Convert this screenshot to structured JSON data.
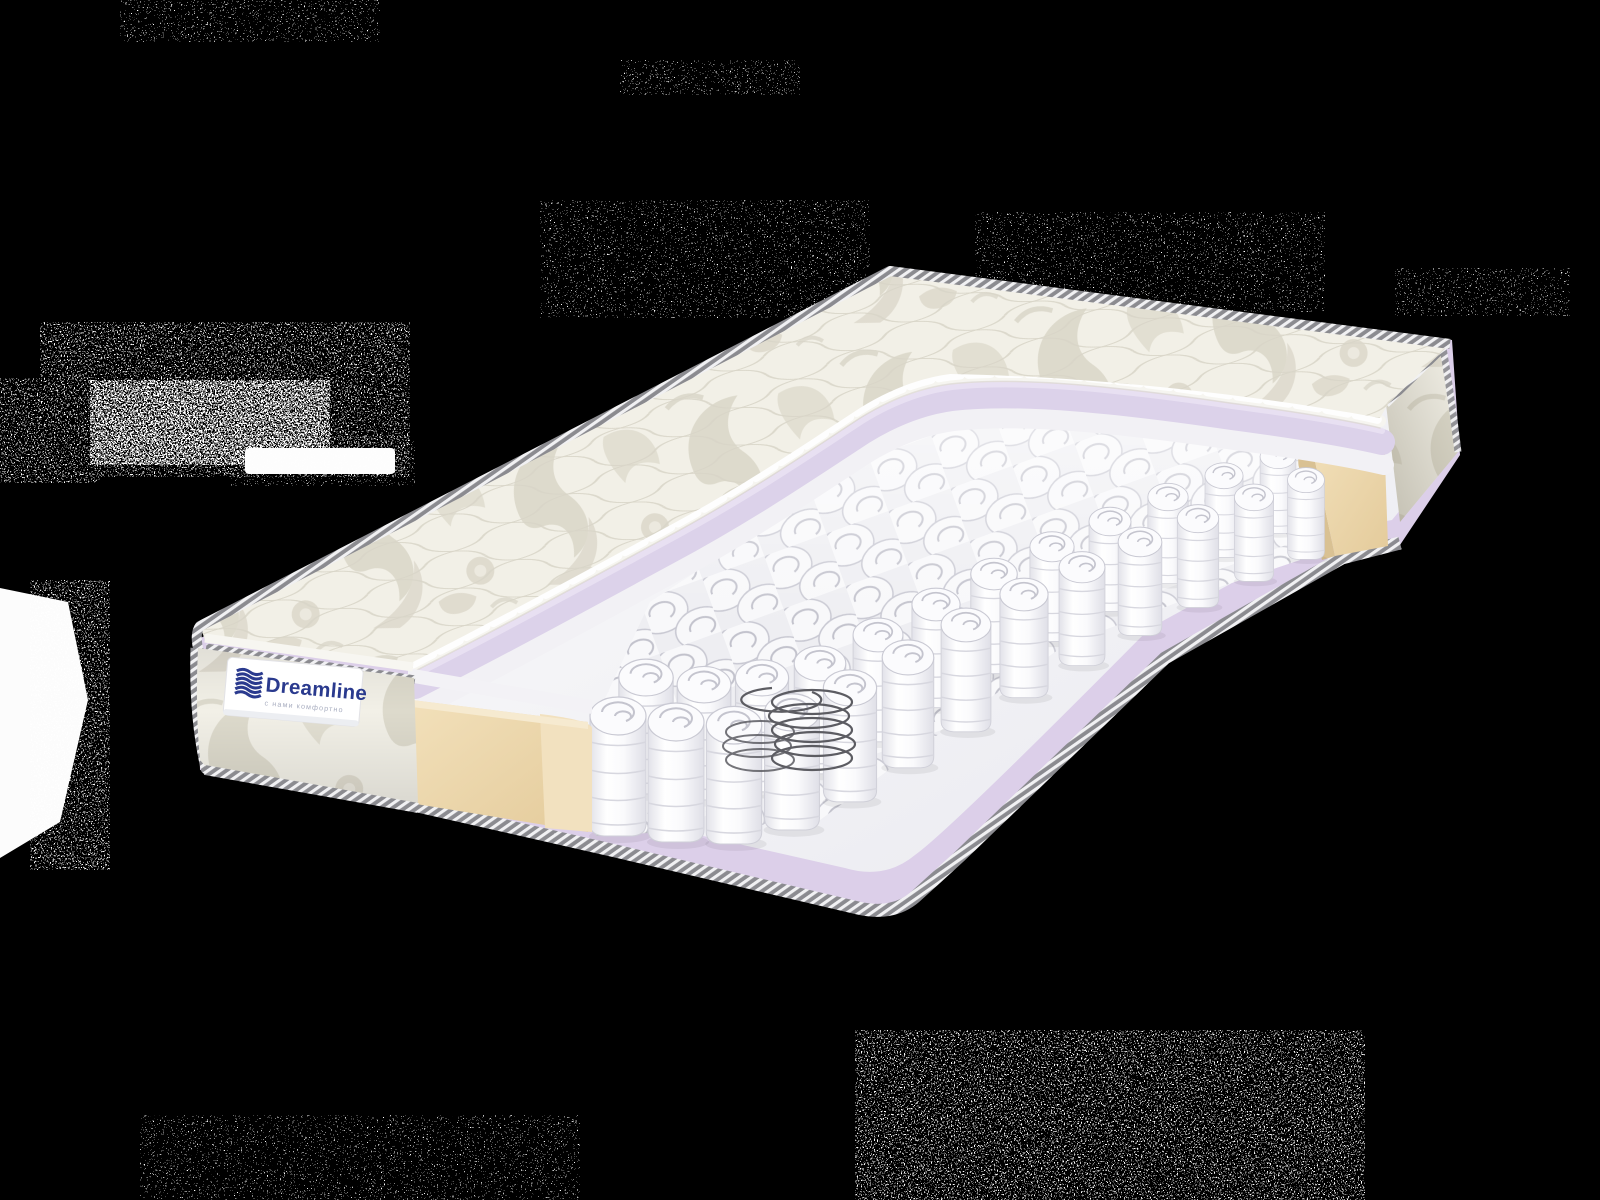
{
  "scene": {
    "type": "product-photo",
    "subject": "pocket-spring mattress cutaway cross-section",
    "background_color": "#000000"
  },
  "product": {
    "brand": "Dreamline",
    "tagline": "с нами комфортно"
  },
  "label": {
    "background": "#ffffff",
    "brand_color": "#2a3a8e",
    "tagline_color": "#a9aec0"
  },
  "palette": {
    "background": "#000000",
    "quilted_fabric": "#f2f0e7",
    "fabric_motif": "#dbd7c9",
    "piping_rope": "#8b8b90",
    "top_foam_lavender": "#dcd2ea",
    "base_foam_lavender": "#dccfe9",
    "felt_layer": "#f2f1f5",
    "edge_support_foam": "#ecd7ad",
    "spring_pockets": "#f8f8fa",
    "steel_coil": "#5c5c62",
    "deck_white": "#f3f3f6"
  }
}
